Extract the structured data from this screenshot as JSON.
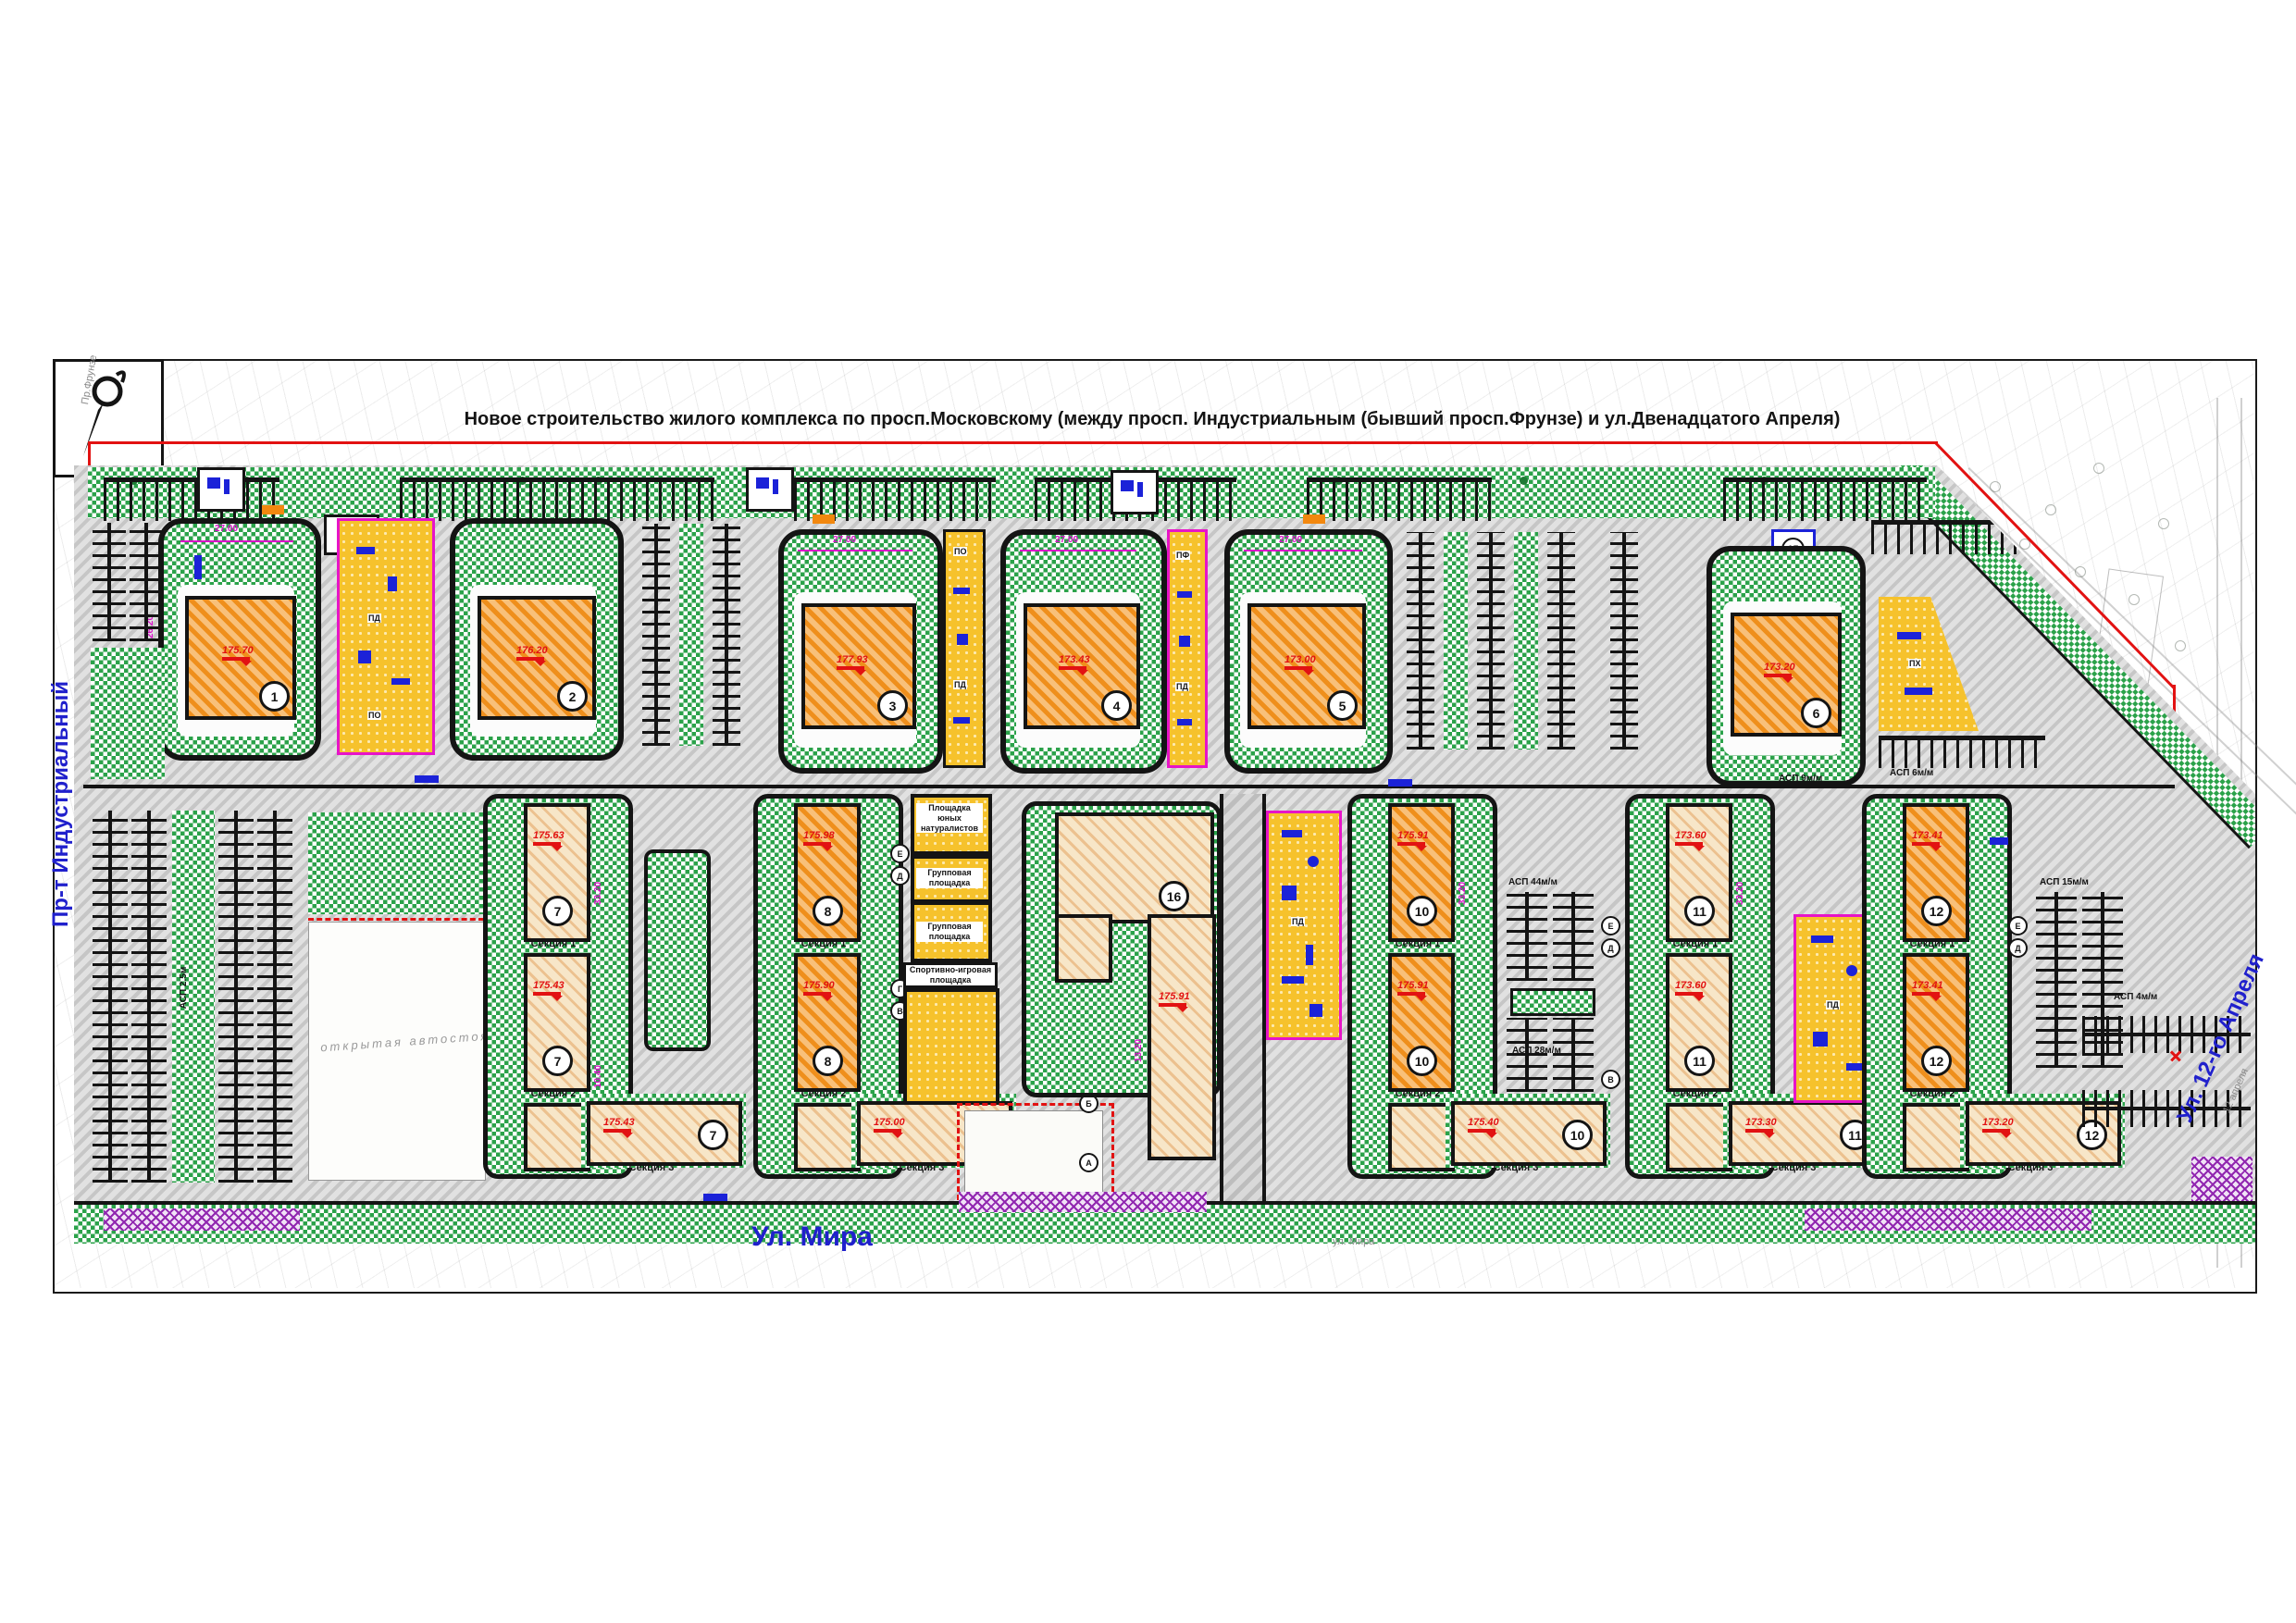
{
  "title": "Новое строительство жилого комплекса по просп.Московскому (между просп. Индустриальным (бывший просп.Фрунзе)  и ул.Двенадцатого Апреля)",
  "streets": {
    "left": "Пр-т Индустриальный",
    "bottom": "Ул. Мира",
    "right": "Ул. 12-го Апреля",
    "bottom_topo": "ул. Мира",
    "left_topo": "Пр.Фрунзе",
    "right_topo": "12 апреля"
  },
  "top_buildings": [
    {
      "num": "1",
      "elev": "175.70"
    },
    {
      "num": "2",
      "elev": "176.20"
    },
    {
      "num": "3",
      "elev": "177.93"
    },
    {
      "num": "4",
      "elev": "173.43"
    },
    {
      "num": "5",
      "elev": "173.00"
    },
    {
      "num": "6",
      "elev": "173.20"
    }
  ],
  "lower_buildings": [
    {
      "num": "7",
      "sections": [
        "Секция 1",
        "Секция 2",
        "Секция 3"
      ],
      "elevs": [
        "175.63",
        "175.43",
        "175.43"
      ]
    },
    {
      "num": "8",
      "sections": [
        "Секция 1",
        "Секция 2",
        "Секция 3"
      ],
      "elevs": [
        "175.98",
        "175.90",
        "175.00"
      ]
    },
    {
      "num": "16",
      "elev": "175.91"
    },
    {
      "num": "10",
      "sections": [
        "Секция 1",
        "Секция 2",
        "Секция 3"
      ],
      "elevs": [
        "175.91",
        "175.91",
        "175.40"
      ]
    },
    {
      "num": "11",
      "sections": [
        "Секция 1",
        "Секция 2",
        "Секция 3"
      ],
      "elevs": [
        "173.60",
        "173.60",
        "173.30"
      ]
    },
    {
      "num": "12",
      "sections": [
        "Секция 1",
        "Секция 2",
        "Секция 3"
      ],
      "elevs": [
        "173.41",
        "173.41",
        "173.20"
      ]
    }
  ],
  "small_structures": {
    "n13": "13",
    "n15": "15"
  },
  "playgrounds": {
    "naturalists": "Площадка юных натуралистов",
    "group": "Групповая площадка",
    "sport": "Спортивно-игровая площадка",
    "pd": "ПД",
    "po": "ПО",
    "pf": "ПФ",
    "ph": "ПХ"
  },
  "parking": {
    "open": "открытая автостоянка",
    "asp44": "АСП 44м/м",
    "asp28": "АСП 28м/м",
    "asp15": "АСП 15м/м",
    "asp9": "АСП 9м/м",
    "asp6": "АСП 6м/м",
    "asp4": "АСП 4м/м",
    "asp25": "АСП 2.5м"
  },
  "nodes": {
    "a": "А",
    "b": "Б",
    "v": "В",
    "g": "Г",
    "d": "Д",
    "e": "Е"
  },
  "dims": {
    "d27": "27.00",
    "d262": "26.20",
    "d332": "33.20",
    "d104": "10.40",
    "d132": "13.20"
  },
  "colors": {
    "boundary_red": "#e21212",
    "street_blue": "#2020cc",
    "magenta": "#d911c9",
    "green": "#2ba24a",
    "orange": "#ef8f1c",
    "yellow": "#f6c22c",
    "purple": "#9127b0",
    "asphalt": "#c9c9c9"
  }
}
